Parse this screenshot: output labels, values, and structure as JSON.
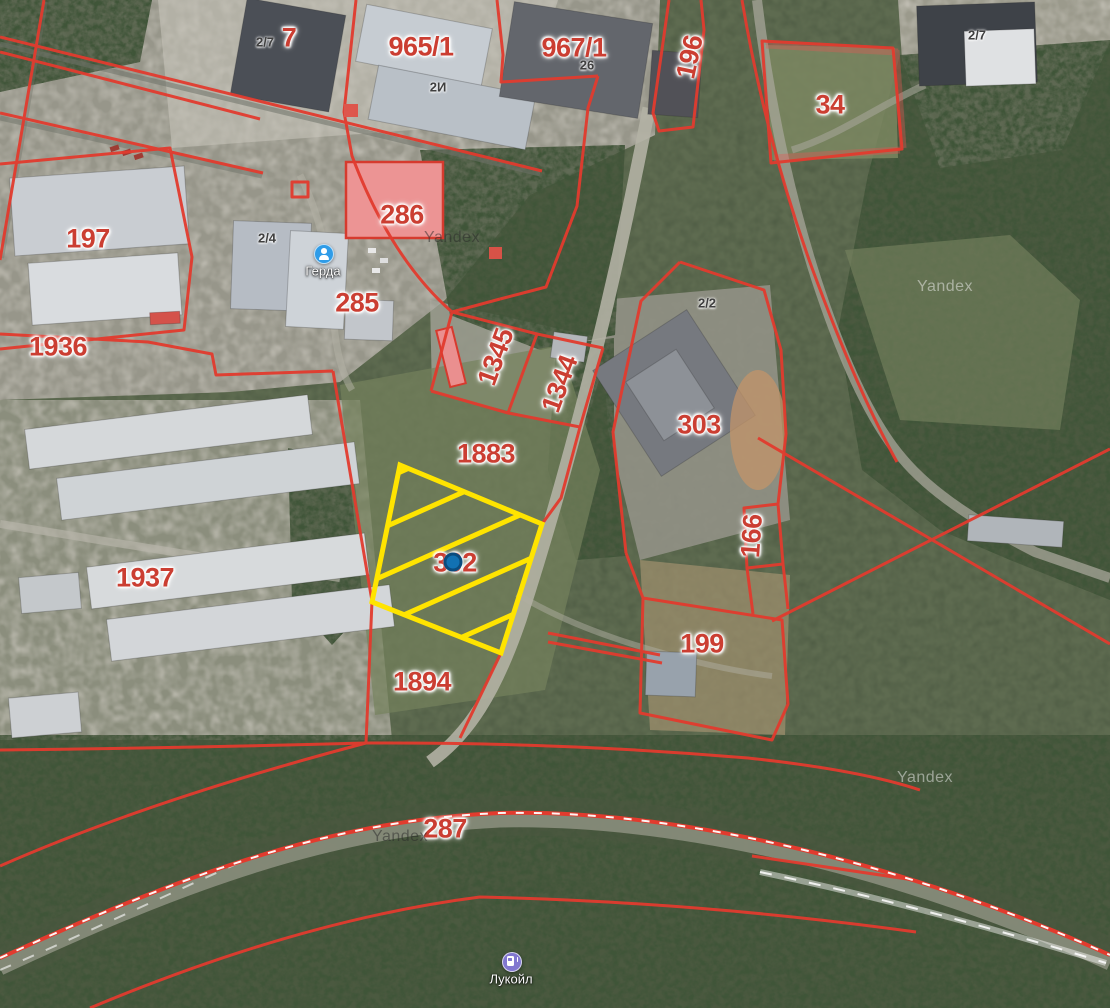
{
  "map": {
    "provider": "Yandex",
    "view": "satellite-with-cadastral-overlay",
    "colors": {
      "boundary_red": "#e23b2e",
      "parcel_label_red": "#cb3e32",
      "detail_label_dark": "#3f3f3f",
      "selected_parcel_yellow": "#ffe400",
      "marker_blue": "#1271b2"
    },
    "parcel_labels": [
      {
        "text": "7",
        "x": 289,
        "y": 38
      },
      {
        "text": "965/1",
        "x": 421,
        "y": 47
      },
      {
        "text": "967/1",
        "x": 574,
        "y": 48
      },
      {
        "text": "196",
        "x": 690,
        "y": 57,
        "rot": -78
      },
      {
        "text": "34",
        "x": 830,
        "y": 105
      },
      {
        "text": "197",
        "x": 88,
        "y": 239
      },
      {
        "text": "286",
        "x": 402,
        "y": 215
      },
      {
        "text": "285",
        "x": 357,
        "y": 303
      },
      {
        "text": "1936",
        "x": 58,
        "y": 347
      },
      {
        "text": "1345",
        "x": 496,
        "y": 357,
        "rot": -70
      },
      {
        "text": "1344",
        "x": 560,
        "y": 384,
        "rot": -70
      },
      {
        "text": "303",
        "x": 699,
        "y": 425
      },
      {
        "text": "1883",
        "x": 486,
        "y": 454
      },
      {
        "text": "302",
        "x": 455,
        "y": 563
      },
      {
        "text": "166",
        "x": 752,
        "y": 536,
        "rot": -86
      },
      {
        "text": "1937",
        "x": 145,
        "y": 578
      },
      {
        "text": "199",
        "x": 702,
        "y": 644
      },
      {
        "text": "1894",
        "x": 422,
        "y": 682
      },
      {
        "text": "287",
        "x": 445,
        "y": 829
      }
    ],
    "detail_labels": [
      {
        "text": "2/7",
        "x": 265,
        "y": 42
      },
      {
        "text": "2И",
        "x": 438,
        "y": 87
      },
      {
        "text": "26",
        "x": 587,
        "y": 65
      },
      {
        "text": "2/4",
        "x": 267,
        "y": 238
      },
      {
        "text": "2/7",
        "x": 977,
        "y": 35
      },
      {
        "text": "2/2",
        "x": 707,
        "y": 303
      }
    ],
    "watermarks": [
      {
        "text": "Yandex",
        "x": 452,
        "y": 238,
        "tone": "dark"
      },
      {
        "text": "Yandex",
        "x": 945,
        "y": 287,
        "tone": "light"
      },
      {
        "text": "Yandex",
        "x": 925,
        "y": 778,
        "tone": "light"
      },
      {
        "text": "Yandex",
        "x": 400,
        "y": 837,
        "tone": "dark"
      }
    ],
    "pois": [
      {
        "name": "Герда",
        "icon": "person",
        "x": 323,
        "y": 253,
        "label_y": 271,
        "color": "#2f9ce8"
      },
      {
        "name": "Лукойл",
        "icon": "fuel",
        "x": 511,
        "y": 961,
        "label_y": 979,
        "color": "#8177d0"
      }
    ],
    "selected_parcel": {
      "label": "302",
      "outline": "#ffe400",
      "hatched": true
    },
    "marker": {
      "x": 453,
      "y": 562,
      "fill": "#1271b2",
      "stroke": "#0b4c7e"
    }
  }
}
